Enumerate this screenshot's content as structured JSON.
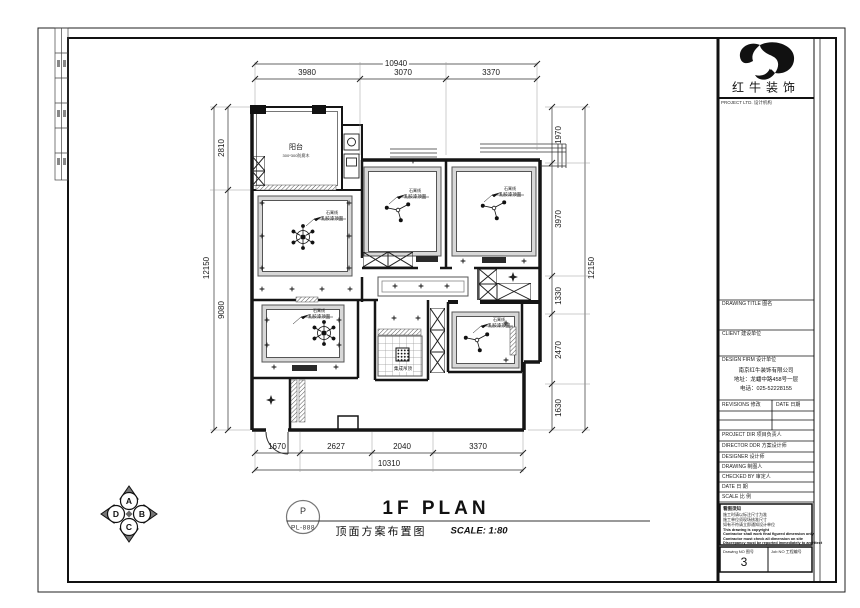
{
  "logo": {
    "name": "红牛装饰",
    "sub": "PROJECT LTD. 设计机构"
  },
  "title_block": {
    "drawing_title_label": "DRAWING TITLE  图名",
    "client_label": "CLIENT  建设单位",
    "design_firm_label": "DESIGN FIRM  设计单位",
    "firm_lines": [
      "南京红牛装饰有限公司",
      "地址：龙蟠中路458号一层",
      "电话：025-52228155"
    ],
    "revisions_label": "REVISIONS 修改",
    "date_col_label": "DATE 日期",
    "rows": [
      "PROJECT DIR  项目负责人",
      "DIRECTOR DDR 方案设计师",
      "DESIGNER  设计师",
      "DRAWING  制图人",
      "CHECKED BY  审定人",
      "DATE  日 期",
      "SCALE  比 例"
    ],
    "notes": [
      "看图须知",
      "施工时请以标注尺寸为准",
      "施工单位须现场核准尺寸",
      "如有不符请立即通知设计单位",
      "This drawing is copyright",
      "Contractor shall work final figured dimension only",
      "Contractor must check all dimension on site",
      "Discrepancy must be reported immediately to architect"
    ],
    "drawing_no_label": "Drawing NO  图号",
    "drawing_no": "3",
    "job_no_label": "Job NO  工程编号"
  },
  "sheet": {
    "stamp_letter": "P",
    "stamp_code": "PL-888",
    "title_en": "1F PLAN",
    "title_cn": "顶面方案布置图",
    "scale": "SCALE: 1:80"
  },
  "compass": {
    "north": "A",
    "east": "B",
    "south": "C",
    "west": "D"
  },
  "dimensions": {
    "top": {
      "total": "10940",
      "segments": [
        "3980",
        "3070",
        "3370"
      ]
    },
    "bottom": {
      "total": "10310",
      "segments": [
        "1670",
        "2627",
        "2040",
        "3370"
      ]
    },
    "left": {
      "total": "12150",
      "segments": [
        "2810",
        "9080"
      ]
    },
    "right": {
      "total": "12150",
      "segments": [
        "1970",
        "3970",
        "1330",
        "2470",
        "1630"
      ]
    }
  },
  "plan": {
    "balcony": {
      "name": "阳台",
      "sub": "300*300防腐木"
    },
    "ceiling_note": {
      "line1": "石膏线",
      "line2": "乳胶漆顶面"
    },
    "bath_note": "集成吊顶"
  }
}
